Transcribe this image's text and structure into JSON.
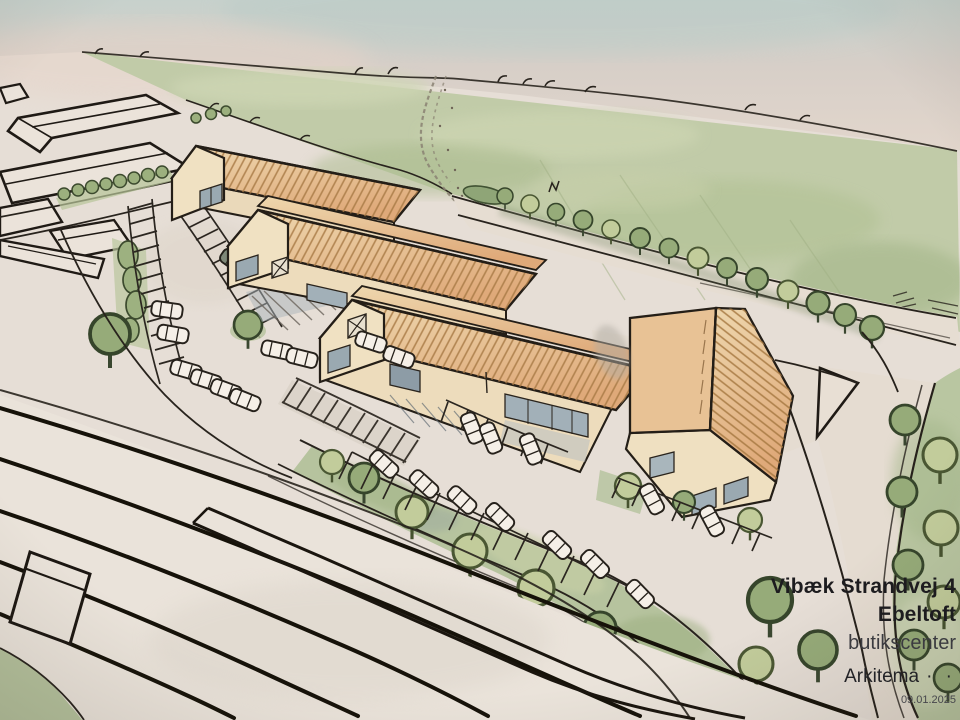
{
  "annotation": {
    "address_line1": "Vibæk Strandvej 4",
    "address_line2": "Ebeltoft",
    "project_type": "butikscenter",
    "firm": "Arkitema",
    "firm_dots": "· ·",
    "date": "09.01.2025"
  },
  "palette": {
    "paper": "#e6ded6",
    "sky_blue_tint": "#c7d1cc",
    "field_green": "#c1cba8",
    "verge_green": "#b9c6a1",
    "roof_orange": "#e2b587",
    "roof_hatch_brown": "#a87a45",
    "wall_cream": "#f0e1c2",
    "window_gray_blue": "#a2b0b8",
    "tree_olive": "#96ab79",
    "tree_light": "#c2cc9b",
    "ink": "#221d17"
  }
}
